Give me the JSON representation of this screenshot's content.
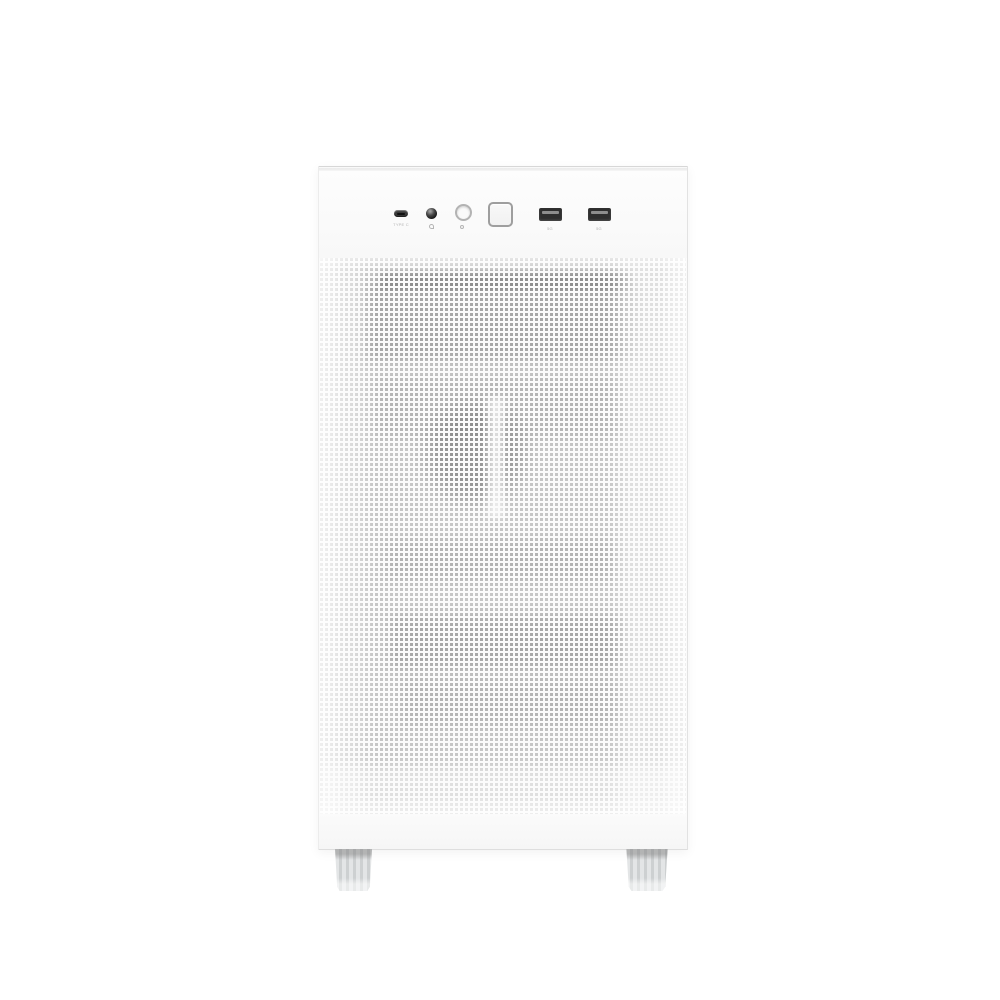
{
  "scene": {
    "description": "Front product photo of a white mini-tower PC case with a perforated mesh front panel, top-front I/O ports and two gray feet",
    "background_color": "#ffffff"
  },
  "case": {
    "body_color": "#fbfbfb",
    "rim_color": "#d7d7d7",
    "io_panel": {
      "ports": [
        {
          "name": "usb-type-c-port",
          "label": "TYPE C"
        },
        {
          "name": "headset-jack",
          "label": ""
        },
        {
          "name": "reset-button",
          "label": ""
        },
        {
          "name": "power-button",
          "label": ""
        },
        {
          "name": "usb-a-port-1",
          "label": "5G"
        },
        {
          "name": "usb-a-port-2",
          "label": "5G"
        }
      ],
      "icons": [
        "headset-icon",
        "reset-icon"
      ]
    },
    "mesh": {
      "hole_color": "#c6c6c6",
      "hole_size_px": 3,
      "pitch_px": 5,
      "interior_shadow_color": "#8f8f8f"
    },
    "bottom_strip_color": "#f6f6f6",
    "feet": {
      "color": "#d8dadb",
      "count_visible": 2
    }
  }
}
